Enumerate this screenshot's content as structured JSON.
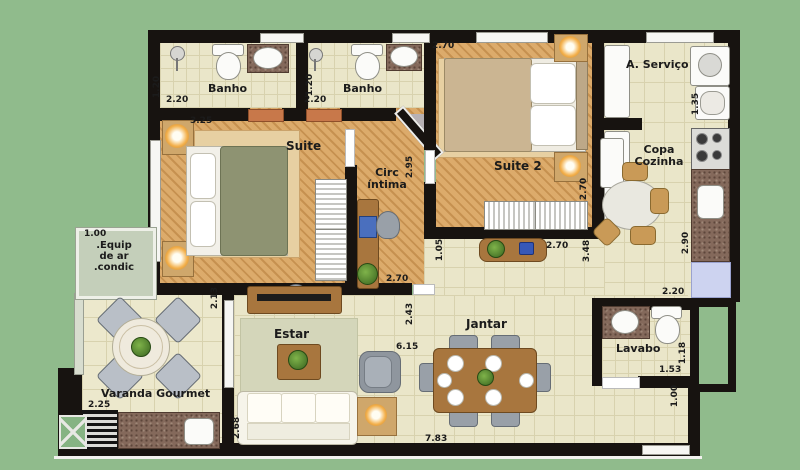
{
  "colors": {
    "background": "#90bb8c",
    "wall": "#171310",
    "wood_floor": "#d9a55f",
    "tile_floor": "#eae6c9",
    "granite": "#84695b",
    "door_accent": "#c8784a",
    "lamp_glow": "#f3b04c"
  },
  "rooms": {
    "banho1": "Banho",
    "banho2": "Banho",
    "suite": "Suite",
    "circ_line1": "Circ",
    "circ_line2": "íntima",
    "suite2": "Suite 2",
    "servico": "A. Serviço",
    "copa_line1": "Copa",
    "copa_line2": "Cozinha",
    "estar": "Estar",
    "jantar": "Jantar",
    "lavabo": "Lavabo",
    "varanda": "Varanda Gourmet",
    "equip_line1": ".Equip",
    "equip_line2": "de ar",
    "equip_line3": ".condic"
  },
  "dims": {
    "banho1_h": "1.20",
    "banho1_w": "2.20",
    "banho2_h": "1.20",
    "banho2_w": "2.20",
    "suite_w": "3.25",
    "suite2_w": "2.70",
    "circ_h": "2.95",
    "suite2_h": "2.70",
    "servico_h": "1.35",
    "copa_h": "2.90",
    "copa_w": "2.20",
    "hall_h": "1.05",
    "hall_w": "2.70",
    "hall_h2": "3.48",
    "circ_w": "2.70",
    "jantar_h": "2.43",
    "jantar_w": "6.15",
    "varanda_h": "2.13",
    "varanda_w": "2.25",
    "estar_h": "2.68",
    "total_w": "7.83",
    "lavabo_h": "1.18",
    "lavabo_w": "1.53",
    "entry_h": "1.00",
    "equip_w": "1.00"
  }
}
